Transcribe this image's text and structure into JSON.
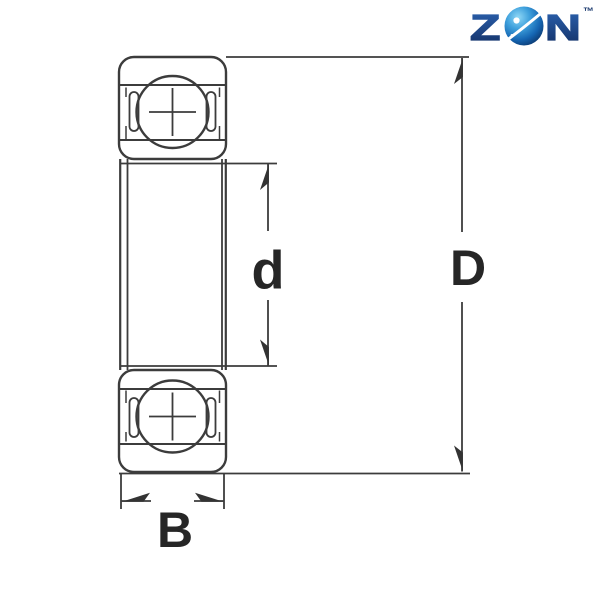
{
  "page": {
    "background_color": "#ffffff",
    "content": "bearing-dimension-diagram"
  },
  "logo": {
    "text_z": "Z",
    "text_n": "N",
    "trademark": "™",
    "letter_color_top": "#2b62b0",
    "letter_color_bottom": "#132f63",
    "globe_highlight_color": "#8fd8f6",
    "globe_mid_color": "#1e74c0",
    "globe_dark_color": "#0a2c5c",
    "swoosh_color": "#ffffff"
  },
  "diagram": {
    "stroke_color": "#3c3c3c",
    "label_color": "#262626",
    "labels": {
      "bore_diameter": "d",
      "outer_diameter": "D",
      "width": "B"
    }
  }
}
